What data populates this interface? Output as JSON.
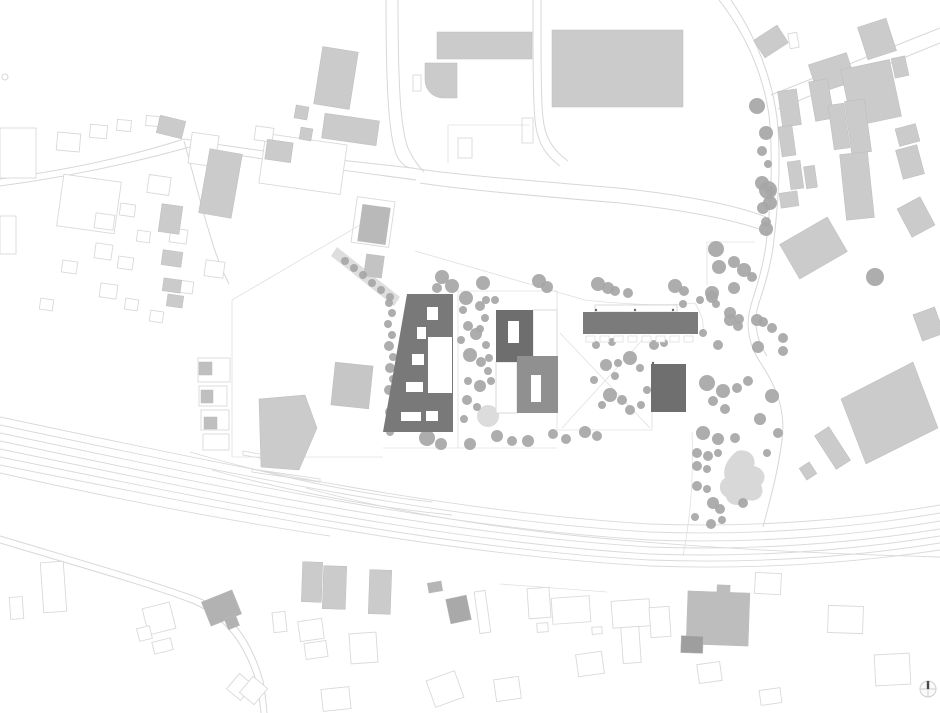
{
  "colors": {
    "bg": "#ffffff",
    "road": "#d7d7d7",
    "rail": "#dadada",
    "boundary": "#e0e0e0",
    "outline": "#d9d9d9",
    "outline_fill": "#ffffff",
    "fill_default": "#cbcbcb",
    "fill_stroke": "#bcbcbc",
    "pavement": "#dedede",
    "plaza": "#dcdcdc",
    "blob": "#d8d8d8",
    "tree": "#a6a6a6",
    "dark_slab": "#797979",
    "dark_house": "#6e6e6e",
    "mid_house": "#909090",
    "bar": "#7b7b7b",
    "square": "#6f6f6f",
    "white": "#ffffff",
    "marker": "#666666",
    "needle": "#4a4a4a",
    "compass": "#cfcfcf"
  },
  "roads": [
    "M0,179 C60,171 125,158 184,139",
    "M0,186 C60,178 125,165 190,147",
    "M184,139 C260,152 340,160 412,168",
    "M190,147 C262,160 342,170 416,180",
    "M412,168 C455,175 525,180 618,188 C692,196 738,206 766,217",
    "M420,183 C458,189 524,195 620,203 C694,211 740,221 770,233",
    "M386,0 C386,80 388,140 398,158 C403,166 408,168 412,168",
    "M398,0 C398,78 400,136 410,152 C414,160 419,167 424,172",
    "M533,0 C533,60 533,100 535,120 C537,142 545,155 560,166",
    "M541,0 C541,60 541,100 543,118 C545,138 553,150 568,161",
    "M719,0 C747,36 763,75 769,115 C774,166 770,210 766,245 C762,272 756,288 751,305 C746,322 747,342 760,362 C776,386 786,410 782,440 C778,472 770,500 763,527",
    "M731,0 C758,40 772,80 777,118 C782,168 777,214 773,248 C769,274 763,290 758,306 C754,320 755,338 767,356",
    "M771,95 L940,28",
    "M778,109 L940,43",
    "M184,141 C193,173 201,206 211,238 C216,256 222,270 229,284",
    "M0,536 C80,560 150,580 196,597 C232,611 252,642 263,681 C265,691 266,702 267,713",
    "M0,543 C80,567 148,586 192,603 C226,617 246,646 257,684 C259,694 260,704 261,713"
  ],
  "rails": [
    "M0,417 C250,470 450,512 650,524 C760,528 860,519 940,505",
    "M0,425 C250,478 450,520 650,532 C760,536 860,527 940,513",
    "M0,433 C250,486 450,528 650,540 C760,544 860,535 940,521",
    "M0,441 C250,494 452,535 650,547 C760,551 860,542 940,529",
    "M0,449 C250,501 452,542 650,554 C760,558 860,549 940,536",
    "M0,457 C250,508 452,549 650,560 C760,564 860,556 940,543",
    "M0,465 C250,515 452,555 650,566 C760,570 860,562 940,550",
    "M190,452 C280,478 360,494 432,502",
    "M212,470 C300,494 380,508 452,515",
    "M306,488 C430,522 600,548 940,557",
    "M0,473 C120,500 230,521 330,536"
  ],
  "boundaries": [
    "M232,300 L232,457",
    "M232,457 L383,457",
    "M232,300 L372,218",
    "M415,251 L585,300",
    "M458,291 L458,448",
    "M458,291 L557,291",
    "M557,291 L557,430",
    "M383,448 L557,448",
    "M557,430 L652,430",
    "M652,412 L652,430",
    "M707,242 L755,242",
    "M707,242 L707,285",
    "M585,300 C630,305 670,306 695,303",
    "M695,303 C702,315 704,322 703,332",
    "M560,333 L650,428",
    "M646,336 L562,428",
    "M448,125 L530,125",
    "M448,125 L448,163",
    "M601,31 L601,106",
    "M692,432 C694,480 690,520 683,556",
    "M500,584 L607,592"
  ],
  "platforms": [
    [
      [
        243,
        451
      ],
      [
        298,
        461
      ],
      [
        298,
        465
      ],
      [
        243,
        455
      ]
    ],
    [
      [
        252,
        469
      ],
      [
        320,
        479
      ],
      [
        320,
        482
      ],
      [
        252,
        472
      ]
    ]
  ],
  "pavement_band": [
    [
      337,
      247
    ],
    [
      400,
      297
    ],
    [
      394,
      306
    ],
    [
      331,
      256
    ]
  ],
  "plaza": [
    488,
    416,
    11
  ],
  "play_blob": "M737,451 C748,448 757,456 754,466 C764,468 768,478 761,485 C766,494 758,503 748,500 C741,508 728,506 726,497 C718,493 718,482 725,478 C722,468 728,458 737,451 Z",
  "rounded_building": "M425,63 h32 v35 h-14 a18,18 0 0 1 -18,-18 z",
  "filled_buildings": [
    [
      318,
      49,
      36,
      58,
      9
    ],
    [
      437,
      32,
      95,
      27,
      0
    ],
    [
      552,
      30,
      131,
      77,
      0
    ],
    [
      295,
      106,
      13,
      13,
      10
    ],
    [
      300,
      128,
      12,
      12,
      10
    ],
    [
      323,
      117,
      55,
      25,
      8
    ],
    [
      204,
      151,
      33,
      65,
      10
    ],
    [
      158,
      118,
      26,
      18,
      14
    ],
    [
      266,
      141,
      26,
      20,
      8
    ],
    [
      360,
      206,
      28,
      37,
      8,
      "#b9b9b9"
    ],
    [
      365,
      255,
      18,
      22,
      8,
      "#c3c3c3"
    ],
    [
      160,
      205,
      21,
      28,
      8
    ],
    [
      162,
      251,
      20,
      15,
      8
    ],
    [
      163,
      279,
      18,
      13,
      8
    ],
    [
      167,
      295,
      16,
      12,
      8
    ],
    [
      333,
      364,
      38,
      43,
      6,
      "#c6c6c6"
    ],
    [
      199,
      362,
      13,
      13,
      0,
      "#bfbfbf"
    ],
    [
      201,
      390,
      12,
      13,
      0,
      "#bfbfbf"
    ],
    [
      204,
      417,
      13,
      12,
      0,
      "#bfbfbf"
    ],
    [
      205,
      595,
      33,
      26,
      -22,
      "#b2b2b2"
    ],
    [
      226,
      617,
      12,
      11,
      -22,
      "#b2b2b2"
    ],
    [
      302,
      562,
      20,
      40,
      2
    ],
    [
      323,
      566,
      23,
      43,
      2
    ],
    [
      369,
      570,
      22,
      44,
      2
    ],
    [
      428,
      582,
      14,
      10,
      -10,
      "#b5b5b5"
    ],
    [
      448,
      597,
      21,
      25,
      -12,
      "#a9a9a9"
    ],
    [
      687,
      592,
      62,
      53,
      2,
      "#bdbdbd"
    ],
    [
      717,
      585,
      13,
      9,
      2,
      "#bdbdbd"
    ],
    [
      681,
      636,
      22,
      17,
      2,
      "#9e9e9e"
    ],
    [
      824,
      428,
      17,
      40,
      -33
    ],
    [
      802,
      464,
      12,
      14,
      -33
    ],
    [
      757,
      31,
      28,
      21,
      -33
    ],
    [
      862,
      22,
      30,
      34,
      -18
    ],
    [
      812,
      58,
      40,
      30,
      -18
    ],
    [
      846,
      64,
      50,
      58,
      -12
    ],
    [
      893,
      57,
      14,
      20,
      -12
    ],
    [
      812,
      80,
      19,
      40,
      -10
    ],
    [
      831,
      104,
      16,
      45,
      -8
    ],
    [
      848,
      100,
      20,
      53,
      -8
    ],
    [
      843,
      153,
      28,
      66,
      -6
    ],
    [
      897,
      126,
      21,
      18,
      -15
    ],
    [
      899,
      147,
      22,
      30,
      -15
    ],
    [
      903,
      201,
      26,
      32,
      -28
    ],
    [
      780,
      90,
      19,
      36,
      -8
    ],
    [
      780,
      126,
      14,
      30,
      -8
    ],
    [
      789,
      161,
      13,
      28,
      -8
    ],
    [
      780,
      192,
      18,
      15,
      -8
    ],
    [
      786,
      228,
      55,
      40,
      -30
    ],
    [
      805,
      166,
      11,
      22,
      -8
    ],
    [
      917,
      310,
      23,
      28,
      -20
    ]
  ],
  "filled_polygons": [
    [
      [
        259,
        399
      ],
      [
        305,
        395
      ],
      [
        317,
        428
      ],
      [
        299,
        470
      ],
      [
        261,
        467
      ]
    ],
    [
      [
        841,
        399
      ],
      [
        913,
        362
      ],
      [
        938,
        428
      ],
      [
        866,
        464
      ]
    ]
  ],
  "outlined_buildings": [
    [
      0,
      128,
      36,
      50,
      0
    ],
    [
      60,
      178,
      58,
      52,
      8
    ],
    [
      148,
      176,
      22,
      18,
      8
    ],
    [
      190,
      134,
      27,
      31,
      8
    ],
    [
      262,
      139,
      82,
      50,
      8
    ],
    [
      255,
      127,
      18,
      14,
      8
    ],
    [
      354,
      199,
      38,
      46,
      8
    ],
    [
      95,
      214,
      19,
      15,
      8
    ],
    [
      120,
      204,
      15,
      12,
      8
    ],
    [
      137,
      231,
      13,
      11,
      8
    ],
    [
      95,
      244,
      17,
      15,
      8
    ],
    [
      118,
      257,
      15,
      12,
      8
    ],
    [
      170,
      229,
      17,
      14,
      8
    ],
    [
      205,
      261,
      19,
      16,
      8
    ],
    [
      100,
      284,
      17,
      14,
      8
    ],
    [
      125,
      299,
      13,
      11,
      8
    ],
    [
      178,
      281,
      15,
      12,
      8
    ],
    [
      150,
      311,
      13,
      11,
      8
    ],
    [
      62,
      261,
      15,
      12,
      8
    ],
    [
      40,
      299,
      13,
      11,
      8
    ],
    [
      57,
      133,
      23,
      18,
      5
    ],
    [
      90,
      125,
      17,
      13,
      5
    ],
    [
      117,
      120,
      14,
      11,
      5
    ],
    [
      146,
      116,
      13,
      10,
      5
    ],
    [
      0,
      216,
      16,
      38,
      0
    ],
    [
      413,
      75,
      8,
      16,
      0
    ],
    [
      458,
      138,
      14,
      20,
      0
    ],
    [
      522,
      118,
      11,
      25,
      0
    ],
    [
      42,
      562,
      23,
      50,
      -4
    ],
    [
      10,
      597,
      13,
      22,
      -4
    ],
    [
      145,
      605,
      28,
      27,
      -14
    ],
    [
      138,
      627,
      13,
      13,
      -14
    ],
    [
      153,
      640,
      19,
      12,
      -14
    ],
    [
      273,
      612,
      13,
      20,
      -6
    ],
    [
      231,
      677,
      18,
      20,
      40
    ],
    [
      244,
      680,
      19,
      21,
      40
    ],
    [
      299,
      620,
      24,
      20,
      -8
    ],
    [
      305,
      642,
      22,
      16,
      -8
    ],
    [
      350,
      633,
      27,
      30,
      -4
    ],
    [
      322,
      688,
      28,
      22,
      -6
    ],
    [
      477,
      591,
      11,
      42,
      -8
    ],
    [
      528,
      588,
      22,
      30,
      -4
    ],
    [
      552,
      597,
      38,
      26,
      -4
    ],
    [
      612,
      600,
      38,
      27,
      -4
    ],
    [
      622,
      627,
      18,
      36,
      -4
    ],
    [
      650,
      607,
      20,
      30,
      -4
    ],
    [
      577,
      653,
      26,
      22,
      -8
    ],
    [
      430,
      675,
      30,
      28,
      -20
    ],
    [
      537,
      623,
      11,
      9,
      -4
    ],
    [
      592,
      627,
      10,
      7,
      -4
    ],
    [
      495,
      678,
      25,
      22,
      -8
    ],
    [
      755,
      573,
      26,
      21,
      3
    ],
    [
      828,
      606,
      35,
      27,
      2
    ],
    [
      875,
      654,
      35,
      31,
      -3
    ],
    [
      698,
      663,
      23,
      19,
      -8
    ],
    [
      760,
      689,
      21,
      15,
      -8
    ],
    [
      198,
      358,
      32,
      24,
      0
    ],
    [
      199,
      386,
      28,
      20,
      0
    ],
    [
      201,
      410,
      28,
      20,
      0
    ],
    [
      203,
      434,
      26,
      16,
      0
    ],
    [
      789,
      33,
      9,
      15,
      -10
    ]
  ],
  "site": {
    "west_slab": {
      "points": [
        [
          407,
          294
        ],
        [
          453,
          294
        ],
        [
          453,
          432
        ],
        [
          383,
          432
        ]
      ],
      "holes": [
        [
          428,
          337,
          24,
          56
        ],
        [
          427,
          307,
          11,
          13
        ],
        [
          417,
          327,
          9,
          12
        ],
        [
          412,
          354,
          12,
          11
        ],
        [
          406,
          382,
          17,
          10
        ],
        [
          401,
          412,
          20,
          9
        ],
        [
          426,
          411,
          12,
          10
        ]
      ]
    },
    "north_house": {
      "rect": [
        496,
        310,
        37,
        52
      ],
      "hole": [
        508,
        321,
        11,
        22
      ],
      "wing": [
        533,
        310,
        24,
        52
      ]
    },
    "south_house": {
      "rect": [
        517,
        356,
        41,
        57
      ],
      "hole": [
        531,
        375,
        10,
        27
      ],
      "wing": [
        496,
        362,
        21,
        51
      ]
    },
    "bar": {
      "rect": [
        583,
        312,
        115,
        22
      ],
      "canopy": [
        595,
        305,
        82,
        7
      ],
      "balcony_y": 336,
      "balcony_xs": [
        586,
        600,
        614,
        628,
        642,
        656,
        670,
        684
      ],
      "balcony_w": 9,
      "balcony_h": 6
    },
    "square": {
      "rect": [
        651,
        364,
        35,
        48
      ]
    }
  },
  "trees": [
    [
      345,
      261,
      4
    ],
    [
      354,
      268,
      4
    ],
    [
      363,
      275,
      4
    ],
    [
      372,
      283,
      4
    ],
    [
      381,
      290,
      4
    ],
    [
      390,
      297,
      4
    ],
    [
      389,
      303,
      4
    ],
    [
      392,
      313,
      4
    ],
    [
      388,
      324,
      4
    ],
    [
      392,
      335,
      4
    ],
    [
      389,
      346,
      5
    ],
    [
      393,
      357,
      4
    ],
    [
      390,
      368,
      5
    ],
    [
      393,
      379,
      4
    ],
    [
      389,
      390,
      5
    ],
    [
      393,
      401,
      4
    ],
    [
      390,
      412,
      5
    ],
    [
      393,
      423,
      4
    ],
    [
      390,
      432,
      4
    ],
    [
      466,
      298,
      7
    ],
    [
      480,
      306,
      5
    ],
    [
      463,
      310,
      4
    ],
    [
      485,
      318,
      4
    ],
    [
      468,
      326,
      5
    ],
    [
      480,
      329,
      4
    ],
    [
      476,
      334,
      6
    ],
    [
      486,
      345,
      4
    ],
    [
      470,
      355,
      7
    ],
    [
      481,
      362,
      5
    ],
    [
      488,
      371,
      4
    ],
    [
      468,
      381,
      4
    ],
    [
      480,
      386,
      6
    ],
    [
      491,
      381,
      4
    ],
    [
      505,
      386,
      5
    ],
    [
      508,
      371,
      4
    ],
    [
      467,
      400,
      5
    ],
    [
      477,
      407,
      4
    ],
    [
      464,
      419,
      4
    ],
    [
      486,
      300,
      4
    ],
    [
      495,
      300,
      4
    ],
    [
      461,
      340,
      4
    ],
    [
      489,
      358,
      4
    ],
    [
      442,
      277,
      7
    ],
    [
      452,
      286,
      7
    ],
    [
      483,
      283,
      7
    ],
    [
      539,
      281,
      7
    ],
    [
      547,
      287,
      6
    ],
    [
      598,
      284,
      7
    ],
    [
      608,
      288,
      6
    ],
    [
      615,
      291,
      5
    ],
    [
      628,
      293,
      5
    ],
    [
      675,
      286,
      7
    ],
    [
      684,
      291,
      5
    ],
    [
      683,
      304,
      4
    ],
    [
      700,
      300,
      4
    ],
    [
      437,
      288,
      5
    ],
    [
      427,
      438,
      8
    ],
    [
      441,
      444,
      6
    ],
    [
      470,
      444,
      6
    ],
    [
      497,
      436,
      6
    ],
    [
      512,
      441,
      5
    ],
    [
      528,
      441,
      6
    ],
    [
      553,
      434,
      5
    ],
    [
      566,
      439,
      5
    ],
    [
      585,
      432,
      6
    ],
    [
      597,
      436,
      5
    ],
    [
      596,
      345,
      4
    ],
    [
      612,
      342,
      4
    ],
    [
      606,
      365,
      6
    ],
    [
      618,
      363,
      4
    ],
    [
      630,
      358,
      7
    ],
    [
      640,
      368,
      4
    ],
    [
      654,
      345,
      5
    ],
    [
      664,
      343,
      4
    ],
    [
      610,
      395,
      7
    ],
    [
      622,
      400,
      5
    ],
    [
      602,
      405,
      4
    ],
    [
      630,
      410,
      5
    ],
    [
      641,
      405,
      4
    ],
    [
      615,
      376,
      4
    ],
    [
      594,
      380,
      4
    ],
    [
      647,
      390,
      4
    ],
    [
      716,
      249,
      8
    ],
    [
      719,
      267,
      7
    ],
    [
      734,
      262,
      6
    ],
    [
      744,
      270,
      7
    ],
    [
      752,
      277,
      5
    ],
    [
      712,
      297,
      6
    ],
    [
      716,
      304,
      4
    ],
    [
      730,
      313,
      6
    ],
    [
      739,
      319,
      5
    ],
    [
      730,
      320,
      6
    ],
    [
      738,
      326,
      5
    ],
    [
      757,
      320,
      6
    ],
    [
      763,
      322,
      5
    ],
    [
      772,
      328,
      5
    ],
    [
      783,
      338,
      5
    ],
    [
      758,
      347,
      6
    ],
    [
      783,
      351,
      5
    ],
    [
      703,
      333,
      4
    ],
    [
      718,
      345,
      5
    ],
    [
      768,
      190,
      9
    ],
    [
      770,
      203,
      7
    ],
    [
      766,
      229,
      7
    ],
    [
      734,
      288,
      6
    ],
    [
      712,
      293,
      7
    ],
    [
      707,
      383,
      8
    ],
    [
      723,
      391,
      7
    ],
    [
      737,
      388,
      5
    ],
    [
      748,
      381,
      5
    ],
    [
      713,
      401,
      5
    ],
    [
      725,
      409,
      5
    ],
    [
      703,
      433,
      7
    ],
    [
      718,
      439,
      6
    ],
    [
      735,
      438,
      5
    ],
    [
      697,
      453,
      5
    ],
    [
      708,
      456,
      5
    ],
    [
      718,
      453,
      4
    ],
    [
      697,
      466,
      5
    ],
    [
      707,
      469,
      4
    ],
    [
      760,
      419,
      6
    ],
    [
      772,
      396,
      7
    ],
    [
      778,
      433,
      5
    ],
    [
      767,
      453,
      4
    ],
    [
      697,
      486,
      5
    ],
    [
      707,
      489,
      4
    ],
    [
      713,
      503,
      6
    ],
    [
      720,
      509,
      5
    ],
    [
      743,
      503,
      5
    ],
    [
      695,
      517,
      4
    ],
    [
      711,
      524,
      5
    ],
    [
      722,
      520,
      4
    ],
    [
      757,
      106,
      8
    ],
    [
      766,
      133,
      7
    ],
    [
      762,
      151,
      5
    ],
    [
      768,
      164,
      4
    ],
    [
      762,
      183,
      7
    ],
    [
      770,
      191,
      5
    ],
    [
      763,
      208,
      6
    ],
    [
      766,
      222,
      5
    ],
    [
      875,
      277,
      9
    ]
  ],
  "markers": [
    [
      596,
      310
    ],
    [
      635,
      310
    ],
    [
      673,
      310
    ],
    [
      653,
      363
    ]
  ],
  "small_circle": [
    5,
    77,
    3
  ],
  "compass": {
    "cx": 928,
    "cy": 689,
    "r": 8
  }
}
